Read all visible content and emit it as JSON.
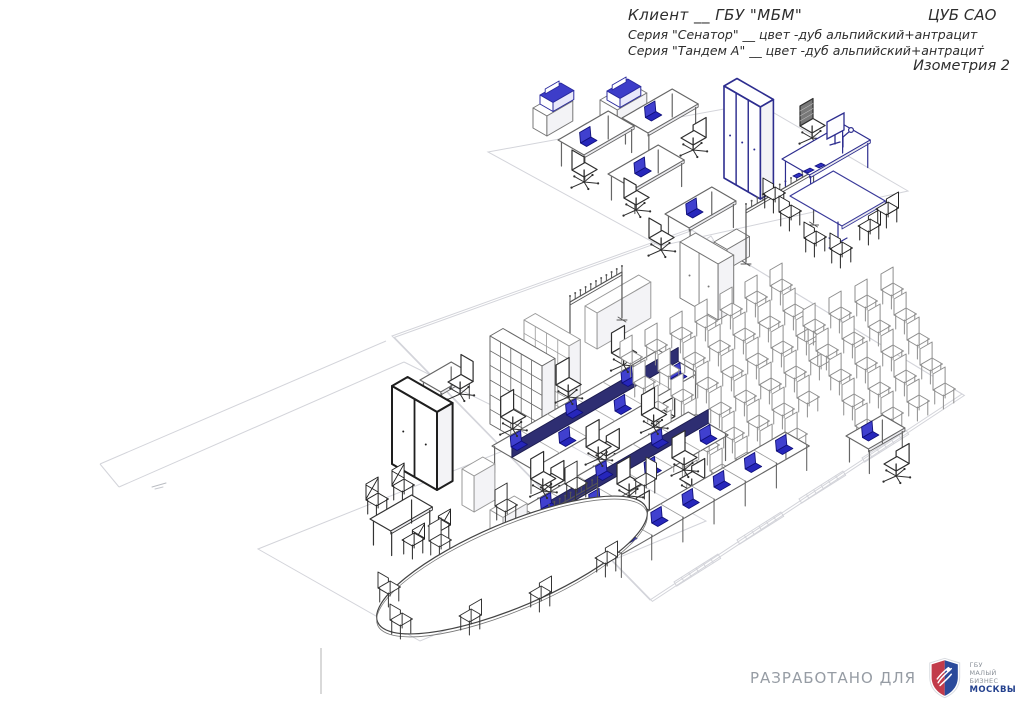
{
  "header": {
    "client_line": "Клиент __ ГБУ \"МБМ\"",
    "right_label": "ЦУБ САО",
    "series_line1": "Серия \"Сенатор\" __ цвет -дуб альпийский+антрацит",
    "series_line2": "Серия \"Тандем А\" __ цвет -дуб альпийский+антрацит",
    "view_label": "Изометрия 2",
    "stray_dash": "."
  },
  "footer": {
    "developed_for": "РАЗРАБОТАНО ДЛЯ",
    "logo": {
      "org": "ГБУ",
      "name_line1": "МАЛЫЙ БИЗНЕС",
      "name_line2": "МОСКВЫ"
    }
  },
  "colors": {
    "wall": "#d3d4da",
    "furniture": "#777777",
    "dark": "#2a2a2a",
    "navy": "#2d2d8f",
    "laptop_fill": "#4040cf",
    "laptop_base": "#2626bb",
    "laptop_stroke": "#10107a",
    "aud_chair": "#8e8e8e",
    "divider_panel": "#2e2e72",
    "logo_red": "#c23b4a",
    "logo_blue": "#2b4a9b"
  },
  "scene": {
    "items": [
      {
        "t": "wall",
        "name": "top-rooms-outline",
        "pts": [
          [
            488,
            152
          ],
          [
            757,
            103
          ],
          [
            908,
            191
          ],
          [
            660,
            246
          ]
        ],
        "closed": true
      },
      {
        "t": "wall",
        "name": "main-hall-outline",
        "pts": [
          [
            392,
            336
          ],
          [
            690,
            229
          ],
          [
            962,
            394
          ],
          [
            650,
            600
          ]
        ],
        "closed": true,
        "dbl": true
      },
      {
        "t": "wall",
        "name": "corridor-wall-a",
        "pts": [
          [
            100,
            464
          ],
          [
            386,
            341
          ]
        ]
      },
      {
        "t": "wall",
        "name": "corridor-wall-b",
        "pts": [
          [
            119,
            487
          ],
          [
            404,
            362
          ]
        ]
      },
      {
        "t": "wall",
        "name": "corridor-end",
        "pts": [
          [
            100,
            464
          ],
          [
            119,
            487
          ]
        ]
      },
      {
        "t": "wall",
        "name": "passage-wall",
        "pts": [
          [
            404,
            362
          ],
          [
            546,
            432
          ]
        ]
      },
      {
        "t": "wall",
        "name": "meeting-room-outline",
        "pts": [
          [
            258,
            549
          ],
          [
            548,
            433
          ],
          [
            706,
            521
          ],
          [
            420,
            641
          ]
        ],
        "closed": true
      },
      {
        "t": "hatch",
        "name": "door-threshold",
        "x": 884,
        "y": 444,
        "len": 52,
        "n": 7
      },
      {
        "t": "hatch",
        "name": "door-threshold",
        "x": 821,
        "y": 485,
        "len": 52,
        "n": 7
      },
      {
        "t": "hatch",
        "name": "door-threshold",
        "x": 759,
        "y": 526,
        "len": 52,
        "n": 7
      },
      {
        "t": "hatch",
        "name": "door-threshold",
        "x": 696,
        "y": 568,
        "len": 52,
        "n": 7
      },
      {
        "t": "hatch",
        "name": "door-threshold",
        "x": 574,
        "y": 131,
        "len": 30,
        "n": 5
      },
      {
        "t": "hatch",
        "name": "door-threshold",
        "x": 700,
        "y": 243,
        "len": 26,
        "n": 4
      },
      {
        "t": "mark",
        "name": "plan-annotation",
        "x": 152,
        "y": 487
      },
      {
        "t": "box",
        "name": "sideboard",
        "x": 533,
        "y": 128,
        "w": 30,
        "d": 16,
        "h": 20
      },
      {
        "t": "printer",
        "name": "plotter",
        "x": 540,
        "y": 104
      },
      {
        "t": "box",
        "name": "printer-stand",
        "x": 600,
        "y": 124,
        "w": 34,
        "d": 20,
        "h": 24
      },
      {
        "t": "printer",
        "name": "printer",
        "x": 607,
        "y": 100
      },
      {
        "t": "desk",
        "name": "office-desk",
        "x": 622,
        "y": 144,
        "w": 58,
        "d": 30,
        "laptop": [
          20,
          12
        ]
      },
      {
        "t": "ochair",
        "name": "office-chair",
        "x": 681,
        "y": 154,
        "back": "se"
      },
      {
        "t": "desk",
        "name": "office-desk",
        "x": 558,
        "y": 166,
        "w": 58,
        "d": 30,
        "laptop": [
          16,
          15
        ]
      },
      {
        "t": "ochair",
        "name": "office-chair",
        "x": 572,
        "y": 186,
        "back": "sw"
      },
      {
        "t": "desk",
        "name": "office-desk",
        "x": 608,
        "y": 200,
        "w": 58,
        "d": 30,
        "laptop": [
          22,
          14
        ]
      },
      {
        "t": "ochair",
        "name": "office-chair",
        "x": 624,
        "y": 214,
        "back": "sw"
      },
      {
        "t": "box",
        "name": "tall-cabinet",
        "x": 724,
        "y": 178,
        "w": 15,
        "d": 42,
        "h": 92,
        "s": "#2d2d8f",
        "lw": 1.6,
        "doors": 3
      },
      {
        "t": "desk",
        "name": "office-desk",
        "x": 665,
        "y": 240,
        "w": 54,
        "d": 28,
        "laptop": [
          18,
          12
        ]
      },
      {
        "t": "ochair",
        "name": "office-chair",
        "x": 649,
        "y": 254,
        "back": "sw"
      },
      {
        "t": "box",
        "name": "low-cabinet",
        "x": 714,
        "y": 262,
        "w": 26,
        "d": 15,
        "h": 20
      },
      {
        "t": "box",
        "name": "two-door-cabinet",
        "x": 680,
        "y": 298,
        "w": 18,
        "d": 44,
        "h": 56,
        "doors": 2
      },
      {
        "t": "rack",
        "name": "coat-rack",
        "x": 746,
        "y": 262,
        "len": 78,
        "h": 52,
        "hooks": 13
      },
      {
        "t": "ochair",
        "name": "exec-chair",
        "x": 800,
        "y": 142,
        "back": "nw",
        "mesh": true
      },
      {
        "t": "desk",
        "name": "exec-desk",
        "x": 782,
        "y": 186,
        "w": 70,
        "d": 32,
        "h": 27,
        "s": "#2d2d8f"
      },
      {
        "t": "monitor",
        "name": "monitor",
        "x": 827,
        "y": 139
      },
      {
        "t": "deskitems",
        "name": "desk-accessories",
        "x": 793,
        "y": 176
      },
      {
        "t": "lamp",
        "name": "desk-lamp",
        "x": 843,
        "y": 133
      },
      {
        "t": "chair",
        "name": "meeting-chair",
        "x": 763,
        "y": 208,
        "back": "sw",
        "s": "#222"
      },
      {
        "t": "chair",
        "name": "meeting-chair",
        "x": 779,
        "y": 226,
        "back": "sw",
        "s": "#222"
      },
      {
        "t": "desk",
        "name": "meeting-table",
        "x": 790,
        "y": 222,
        "w": 50,
        "d": 60,
        "h": 26,
        "s": "#3a3a9a",
        "nolegs": true
      },
      {
        "t": "pedestal",
        "name": "table-pedestal",
        "x": 838,
        "y": 224
      },
      {
        "t": "chair",
        "name": "meeting-chair",
        "x": 858,
        "y": 240,
        "back": "se",
        "s": "#222"
      },
      {
        "t": "chair",
        "name": "meeting-chair",
        "x": 876,
        "y": 223,
        "back": "se",
        "s": "#222"
      },
      {
        "t": "chair",
        "name": "meeting-chair",
        "x": 804,
        "y": 252,
        "back": "sw",
        "s": "#222"
      },
      {
        "t": "chair",
        "name": "meeting-chair",
        "x": 830,
        "y": 263,
        "back": "sw",
        "s": "#222"
      },
      {
        "t": "box",
        "name": "long-cabinet",
        "x": 585,
        "y": 342,
        "w": 62,
        "d": 14,
        "h": 36,
        "s": "#999"
      },
      {
        "t": "rack",
        "name": "coat-rack",
        "x": 570,
        "y": 348,
        "len": 60,
        "h": 46,
        "hooks": 11
      },
      {
        "t": "box",
        "name": "shelf-unit",
        "x": 524,
        "y": 400,
        "w": 13,
        "d": 52,
        "h": 80,
        "s": "#9a9a9a",
        "grid": [
          4,
          6
        ]
      },
      {
        "t": "box",
        "name": "shelf-unit",
        "x": 490,
        "y": 424,
        "w": 15,
        "d": 60,
        "h": 88,
        "s": "#666",
        "grid": [
          5,
          6
        ]
      },
      {
        "t": "bench",
        "name": "bench-workstations",
        "x": 492,
        "y": 472,
        "m": 6
      },
      {
        "t": "chairGrid",
        "name": "auditorium-chairs",
        "x": 620,
        "y": 372,
        "rows": [
          7,
          7,
          7,
          7,
          6,
          5
        ],
        "cs": [
          25,
          -12
        ],
        "rs": [
          13,
          25
        ]
      },
      {
        "t": "chairGrid",
        "name": "auditorium-chairs",
        "x": 803,
        "y": 340,
        "rows": [
          4,
          4,
          4,
          4,
          4
        ],
        "cs": [
          26,
          -12
        ],
        "rs": [
          13,
          25
        ]
      },
      {
        "t": "bench",
        "name": "bench-workstations",
        "x": 522,
        "y": 534,
        "m": 6
      },
      {
        "t": "ochair",
        "name": "office-chair",
        "x": 617,
        "y": 500,
        "back": "nw"
      },
      {
        "t": "ochair",
        "name": "office-chair",
        "x": 672,
        "y": 474,
        "back": "nw"
      },
      {
        "t": "ochair",
        "name": "office-chair",
        "x": 607,
        "y": 546,
        "back": "sw"
      },
      {
        "t": "counter",
        "name": "training-desk-row",
        "x": 598,
        "y": 565,
        "m": 6
      },
      {
        "t": "desk",
        "name": "presenter-desk",
        "x": 846,
        "y": 462,
        "w": 42,
        "d": 26,
        "laptop": [
          14,
          10
        ]
      },
      {
        "t": "ochair",
        "name": "office-chair",
        "x": 884,
        "y": 480,
        "back": "se"
      },
      {
        "t": "desk",
        "name": "side-table",
        "x": 420,
        "y": 404,
        "w": 36,
        "d": 24,
        "h": 24
      },
      {
        "t": "ochair",
        "name": "office-chair",
        "x": 448,
        "y": 398,
        "back": "ne"
      },
      {
        "t": "box",
        "name": "wardrobe",
        "x": 392,
        "y": 464,
        "w": 18,
        "d": 52,
        "h": 78,
        "s": "#1e1e1e",
        "lw": 2,
        "doors": 2
      },
      {
        "t": "box",
        "name": "pedestal-box",
        "x": 462,
        "y": 505,
        "w": 24,
        "d": 14,
        "h": 36,
        "s": "#999"
      },
      {
        "t": "box",
        "name": "pedestal-box",
        "x": 490,
        "y": 538,
        "w": 28,
        "d": 15,
        "h": 28,
        "s": "#999"
      },
      {
        "t": "rack",
        "name": "coat-rack",
        "x": 549,
        "y": 563,
        "len": 56,
        "h": 52,
        "hooks": 10
      },
      {
        "t": "chair",
        "name": "wood-chair",
        "x": 366,
        "y": 514,
        "back": "nw",
        "s": "#222",
        "cross": true
      },
      {
        "t": "chair",
        "name": "wood-chair",
        "x": 392,
        "y": 500,
        "back": "nw",
        "s": "#222",
        "cross": true
      },
      {
        "t": "desk",
        "name": "tea-table",
        "x": 370,
        "y": 545,
        "w": 48,
        "d": 24,
        "s": "#333"
      },
      {
        "t": "chair",
        "name": "wood-chair",
        "x": 402,
        "y": 554,
        "back": "se",
        "s": "#222",
        "cross": true
      },
      {
        "t": "chair",
        "name": "wood-chair",
        "x": 428,
        "y": 540,
        "back": "se",
        "s": "#222",
        "cross": true
      },
      {
        "t": "chair",
        "name": "conference-chair",
        "x": 495,
        "y": 520,
        "back": "nw",
        "s": "#333"
      },
      {
        "t": "chair",
        "name": "conference-chair",
        "x": 565,
        "y": 498,
        "back": "nw",
        "s": "#333"
      },
      {
        "t": "chair",
        "name": "conference-chair",
        "x": 429,
        "y": 555,
        "back": "nw",
        "s": "#333"
      },
      {
        "t": "chair",
        "name": "conference-chair",
        "x": 634,
        "y": 494,
        "back": "ne",
        "s": "#333"
      },
      {
        "t": "oval",
        "name": "conference-table",
        "x": 512,
        "y": 565,
        "rx": 146,
        "ry": 42,
        "rot": -23
      },
      {
        "t": "chair",
        "name": "conference-chair",
        "x": 378,
        "y": 602,
        "back": "sw",
        "s": "#333"
      },
      {
        "t": "chair",
        "name": "conference-chair",
        "x": 390,
        "y": 634,
        "back": "sw",
        "s": "#333"
      },
      {
        "t": "chair",
        "name": "conference-chair",
        "x": 459,
        "y": 630,
        "back": "se",
        "s": "#333"
      },
      {
        "t": "chair",
        "name": "conference-chair",
        "x": 529,
        "y": 607,
        "back": "se",
        "s": "#333"
      },
      {
        "t": "chair",
        "name": "conference-chair",
        "x": 595,
        "y": 572,
        "back": "se",
        "s": "#333"
      }
    ]
  }
}
